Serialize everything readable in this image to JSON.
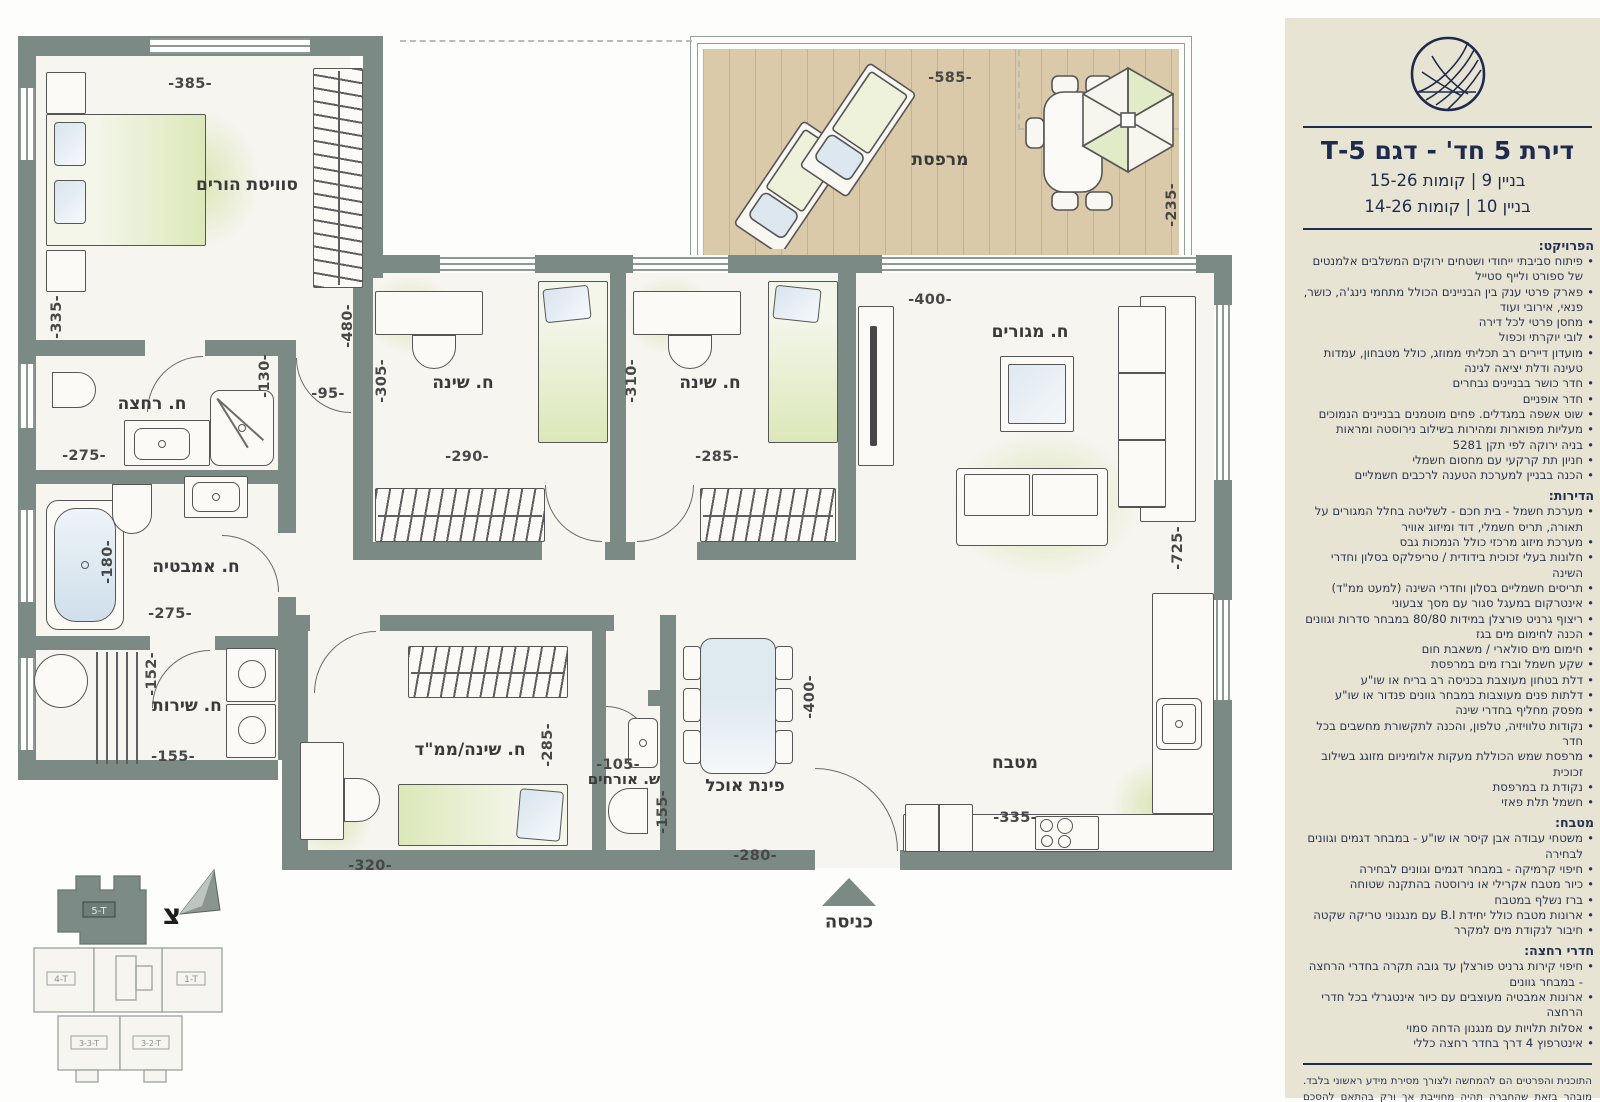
{
  "sidebar": {
    "title": "דירת 5 חד' - דגם 5-T",
    "subtitle1": "בניין 9 | קומות 15-26",
    "subtitle2": "בניין 10 | קומות 14-26",
    "sections": [
      {
        "heading": "הפרויקט:",
        "items": [
          "פיתוח סביבתי ייחודי ושטחים ירוקים המשלבים אלמנטים של ספורט ולייף סטייל",
          "פארק פרטי ענק בין הבניינים הכולל מתחמי נינג'ה, כושר, פנאי, אירובי ועוד",
          "מחסן פרטי לכל דירה",
          "לובי יוקרתי וכפול",
          "מועדון דיירים רב תכליתי ממוזג, כולל מטבחון, עמדות טעינה ודלת יציאה לגינה",
          "חדר כושר בבניינים נבחרים",
          "חדר אופניים",
          "שוט אשפה במגדלים. פחים מוטמנים בבניינים הנמוכים",
          "מעליות מפוארות ומהירות בשילוב נירוסטה ומראות",
          "בניה ירוקה לפי תקן 5281",
          "חניון תת קרקעי עם מחסום חשמלי",
          "הכנה בבניין למערכת הטענה לרכבים חשמליים"
        ]
      },
      {
        "heading": "הדירות:",
        "items": [
          "מערכת חשמל - בית חכם - לשליטה בחלל המגורים על תאורה, תריס חשמלי, דוד ומיזוג אוויר",
          "מערכת מיזוג מרכזי כולל הנמכות גבס",
          "חלונות בעלי זכוכית בידודית / טריפלקס בסלון וחדרי השינה",
          "תריסים חשמליים בסלון וחדרי השינה (למעט ממ\"ד)",
          "אינטרקום במעגל סגור עם מסך צבעוני",
          "ריצוף גרניט פורצלן במידות 80/80 במבחר סדרות וגוונים",
          "הכנה לחימום מים בגז",
          "חימום מים סולארי / משאבת חום",
          "שקע חשמל וברז מים במרפסת",
          "דלת בטחון מעוצבת בכניסה רב בריח או שו\"ע",
          "דלתות פנים מעוצבות במבחר גוונים פנדור או שו\"ע",
          "מפסק מחליף בחדרי שינה",
          "נקודות טלוויזיה, טלפון, והכנה לתקשורת מחשבים בכל חדר",
          "מרפסת שמש הכוללת מעקות אלומיניום מזוגג בשילוב זכוכית",
          "נקודת גז במרפסת",
          "חשמל תלת פאזי"
        ]
      },
      {
        "heading": "מטבח:",
        "items": [
          "משטחי עבודה אבן קיסר או שו\"ע - במבחר דגמים וגוונים לבחירה",
          "חיפוי קרמיקה - במבחר דגמים וגוונים לבחירה",
          "כיור מטבח אקרילי או נירוסטה בהתקנה שטוחה",
          "ברז נשלף במטבח",
          "ארונות מטבח כולל יחידת B.I עם מנגנוני טריקה שקטה",
          "חיבור לנקודת מים למקרר"
        ]
      },
      {
        "heading": "חדרי רחצה:",
        "items": [
          "חיפוי קירות גרניט פורצלן עד גובה תקרה בחדרי הרחצה - במבחר גוונים",
          "ארונות אמבטיה מעוצבים עם כיור אינטגרלי בכל חדרי הרחצה",
          "אסלות תלויות עם מנגנון הדחה סמוי",
          "אינטרפוץ 4 דרך בחדר רחצה כללי"
        ]
      }
    ],
    "disclaimer": "התוכנית והפרטים הם להמחשה ולצורך מסירת מידע ראשוני בלבד. מובהר בזאת שהחברה תהיה מחוייבת אך ורק בהתאם להסכם המכר ולנספחיו לפי חוק מכר ושעליו יחתמו החברה והרוכשים. ט.ל.ח."
  },
  "plan": {
    "rooms": [
      {
        "label": "סוויטת הורים"
      },
      {
        "label": "ח. רחצה"
      },
      {
        "label": "ח. אמבטיה"
      },
      {
        "label": "ח. שירות"
      },
      {
        "label": "ח. שינה"
      },
      {
        "label": "ח. שינה"
      },
      {
        "label": "ח. מגורים"
      },
      {
        "label": "מרפסת"
      },
      {
        "label": "מטבח"
      },
      {
        "label": "פינת אוכל"
      },
      {
        "label": "ח. שינה/ממ\"ד"
      },
      {
        "label": "ש. אורחים"
      }
    ],
    "dims": [
      "-385-",
      "-335-",
      "-480-",
      "-130-",
      "-95-",
      "-275-",
      "-180-",
      "-275-",
      "-152-",
      "-155-",
      "-305-",
      "-290-",
      "-310-",
      "-285-",
      "-400-",
      "-725-",
      "-585-",
      "-235-",
      "-400-",
      "-280-",
      "-335-",
      "-285-",
      "-320-",
      "-105-",
      "-155-"
    ],
    "entrance": "כניסה",
    "north": "צ"
  },
  "keyplan": {
    "units": [
      {
        "label": "5-T",
        "highlighted": true
      },
      {
        "label": "4-T",
        "highlighted": false
      },
      {
        "label": "1-T",
        "highlighted": false
      },
      {
        "label": "3-3-T",
        "highlighted": false
      },
      {
        "label": "3-2-T",
        "highlighted": false
      }
    ]
  },
  "colors": {
    "wall": "#7b8a84",
    "room": "#f6f5f0",
    "sidebar_bg": "#e8e4d4",
    "navy": "#1f2b4e",
    "wood": "#dbcaa9",
    "accent_green": "#dce8b9"
  }
}
